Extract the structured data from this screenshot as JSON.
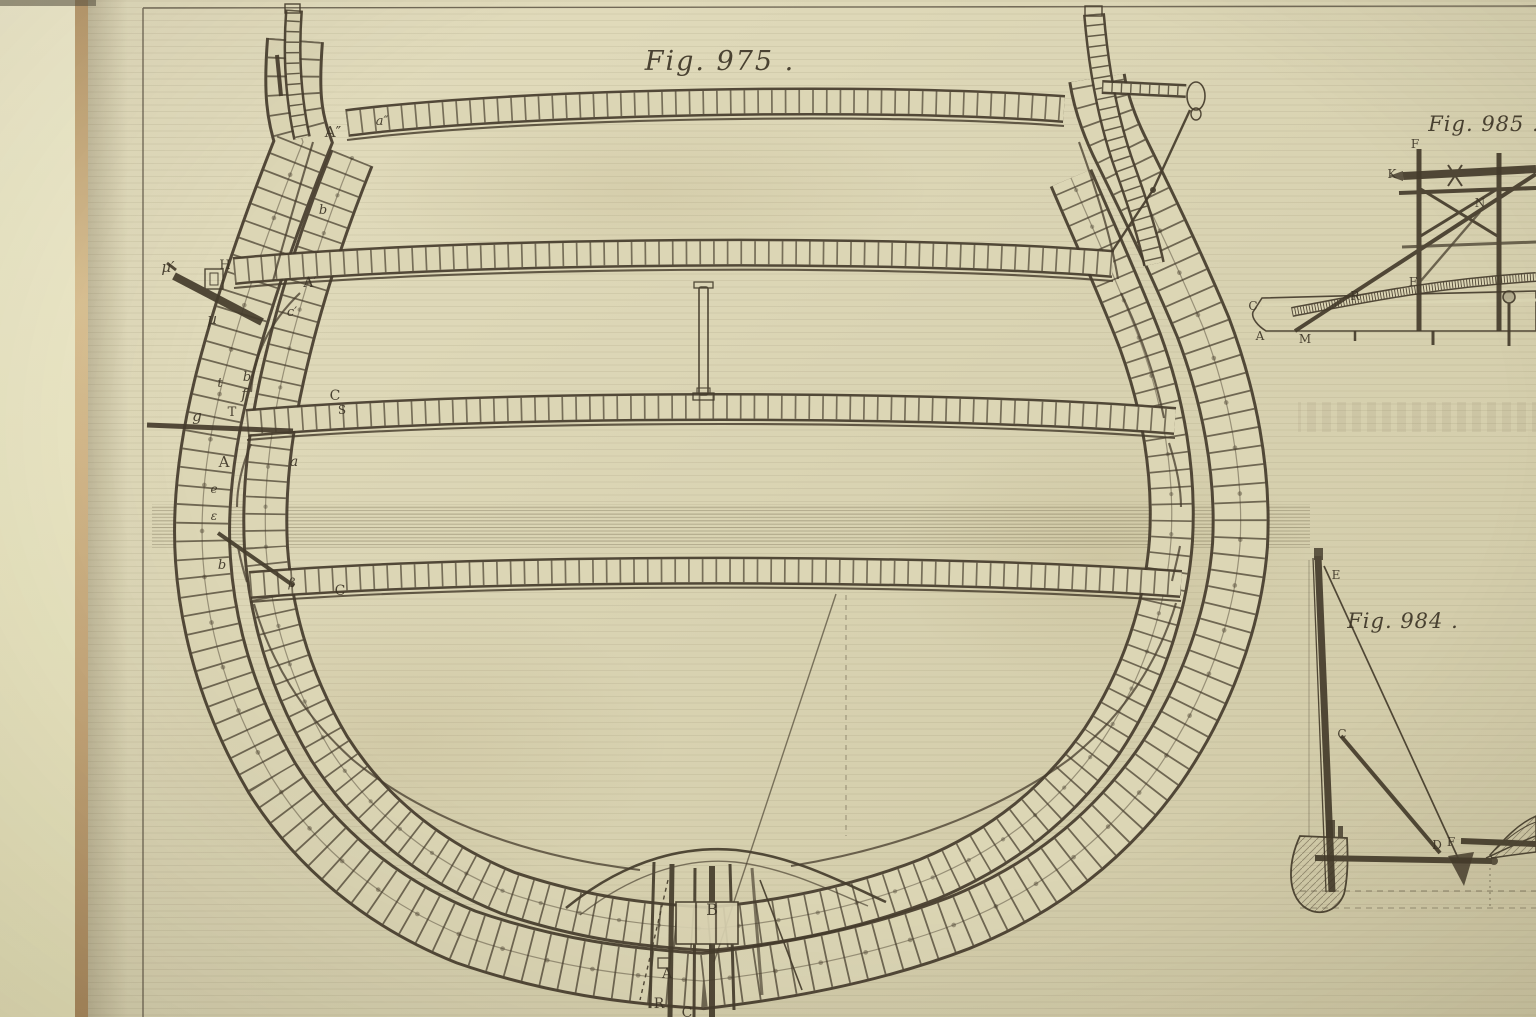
{
  "photo": {
    "description_colors": {
      "background_left_strip": "#efebca",
      "page_edge": "#c8a97c",
      "plate_paper": "#d9d3b2",
      "engraving_ink": "#453c2c"
    }
  },
  "figures": {
    "fig975": {
      "title": "Fig. 975 .",
      "labels": {
        "a_sec": "A″",
        "aa_sec": "a″",
        "b_top": "b",
        "mu_prime": "µ′",
        "h": "H",
        "a_prime": "A′",
        "c_prime": "c′",
        "mu": "µ",
        "b1": "b",
        "t": "t",
        "f": "f",
        "g": "g",
        "t_cap": "T",
        "c_cap": "C",
        "s_cap": "S",
        "a_cap": "A",
        "a_low": "a",
        "e_low": "e",
        "epsilon": "ε",
        "b2": "b",
        "beta": "β",
        "c2": "C",
        "b_keel": "B",
        "a_keel": "A",
        "r_keel": "R",
        "c_keel": "C"
      }
    },
    "fig985": {
      "title": "Fig. 985 .",
      "labels": {
        "f_top": "F",
        "k": "K",
        "n": "N",
        "r": "R",
        "f_deck": "F",
        "c": "C",
        "a": "A",
        "m": "M"
      }
    },
    "fig984": {
      "title": "Fig. 984 .",
      "labels": {
        "e": "E",
        "c": "C",
        "d": "D",
        "f": "F"
      }
    }
  }
}
